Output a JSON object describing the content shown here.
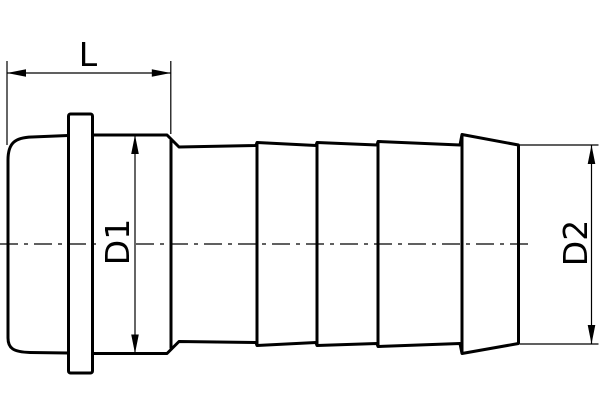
{
  "drawing": {
    "description": "Technical line drawing of a hose barb fitting (side view) with dimension callouts",
    "background_color": "#ffffff",
    "line_color": "#000000",
    "labels": {
      "length": "L",
      "socket_diameter": "D1",
      "tail_diameter": "D2"
    }
  }
}
